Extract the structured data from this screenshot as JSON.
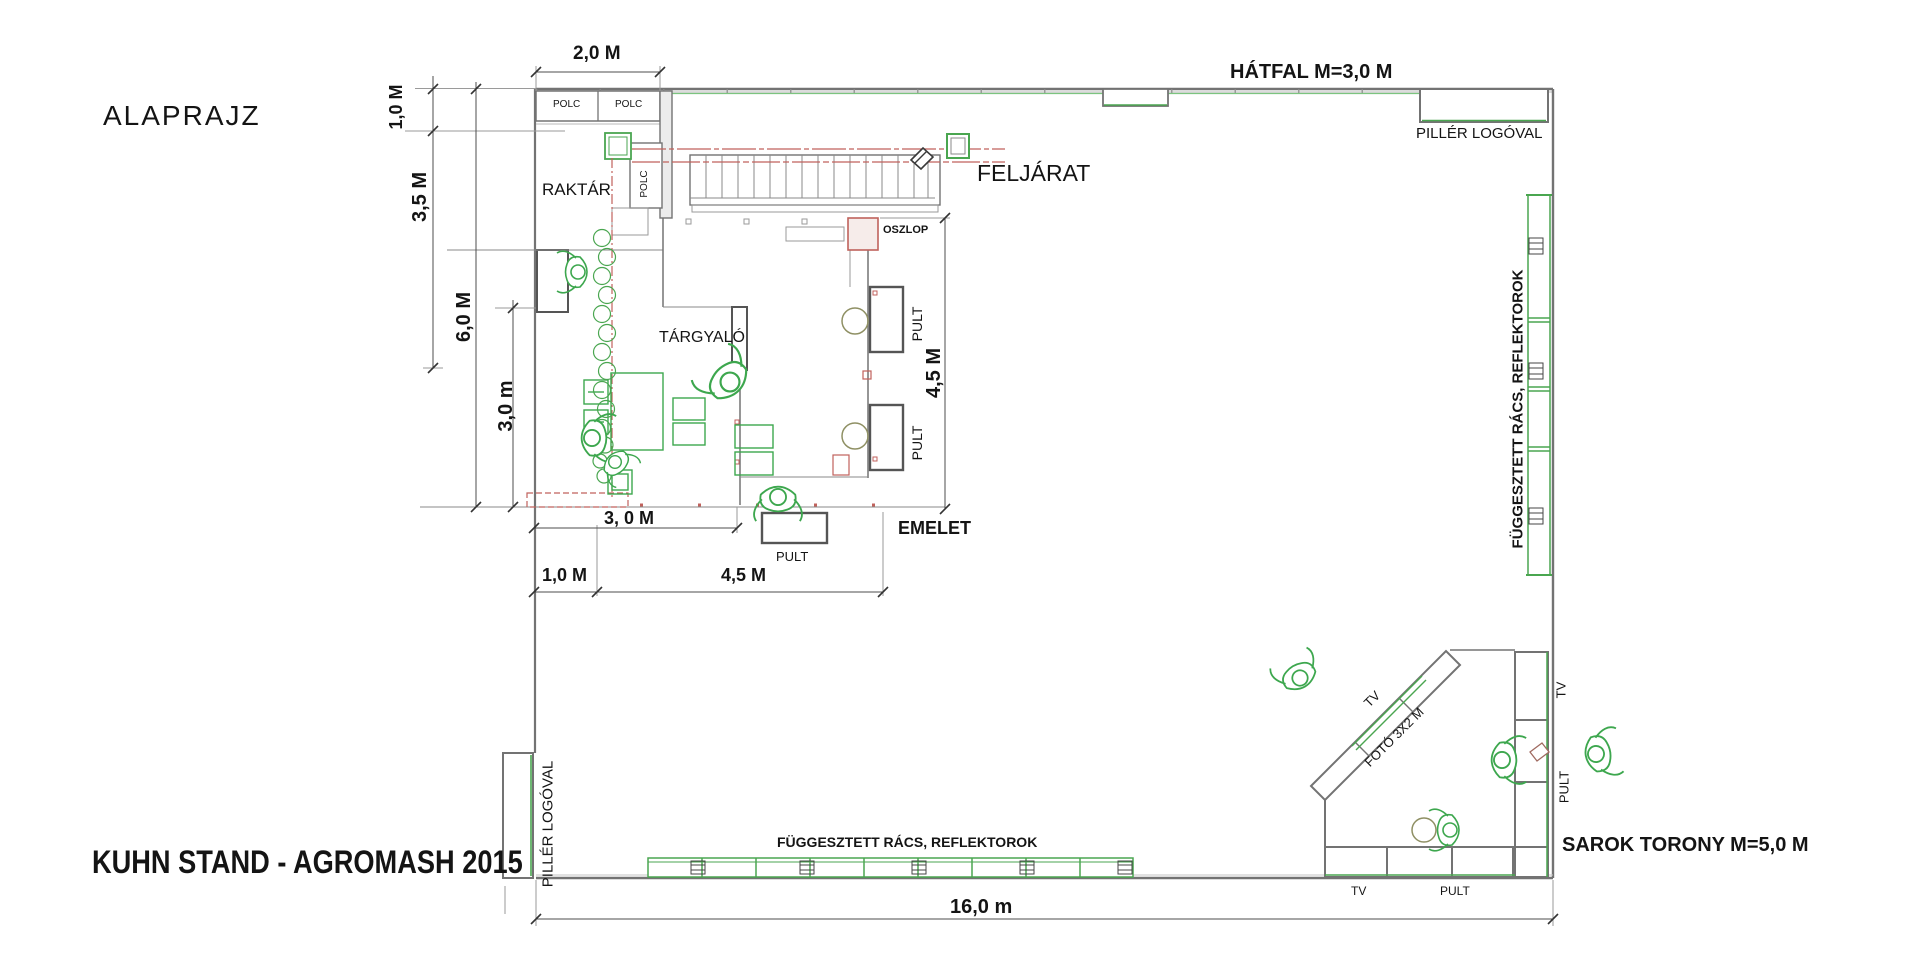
{
  "page": {
    "title": "ALAPRAJZ",
    "project_title": "KUHN STAND - AGROMASH 2015"
  },
  "stand": {
    "back_wall_label": "HÁTFAL M=3,0 M",
    "pillar_top_label": "PILLÉR LOGÓVAL",
    "pillar_bottom_label": "PILLÉR LOGÓVAL",
    "right_rack_label": "FÜGGESZTETT RÁCS, REFLEKTOROK",
    "bottom_rack_label": "FÜGGESZTETT RÁCS, REFLEKTOROK",
    "total_width_dim": "16,0 m",
    "corner_tower_label": "SAROK TORONY M=5,0 M"
  },
  "mezzanine": {
    "shelf1": "POLC",
    "shelf2": "POLC",
    "shelf3": "POLC",
    "storage_label": "RAKTÁR",
    "meeting_room_label": "TÁRGYALÓ",
    "stairs_label": "FELJÁRAT",
    "column_label": "OSZLOP",
    "counter_right1": "PULT",
    "counter_right2": "PULT",
    "counter_bottom": "PULT",
    "upper_floor_label": "EMELET",
    "dims": {
      "top_width": "2,0 M",
      "v1": "1,0 M",
      "v2": "3,5 M",
      "v3": "6,0 M",
      "v4": "3,0 m",
      "right_height": "4,5 M",
      "bottom1": "3, 0 M",
      "bottom2": "1,0 M",
      "bottom3": "4,5 M"
    }
  },
  "corner_tower": {
    "tv_diagonal": "TV",
    "photo_label": "FOTÓ 3X2 M",
    "tv_right": "TV",
    "counter_right": "PULT",
    "tv_bottom": "TV",
    "counter_bottom": "PULT"
  },
  "colors": {
    "wall_gray": "#737373",
    "accent_green": "#3da74e",
    "accent_red": "#c0625c",
    "stool_olive": "#8f9064"
  }
}
